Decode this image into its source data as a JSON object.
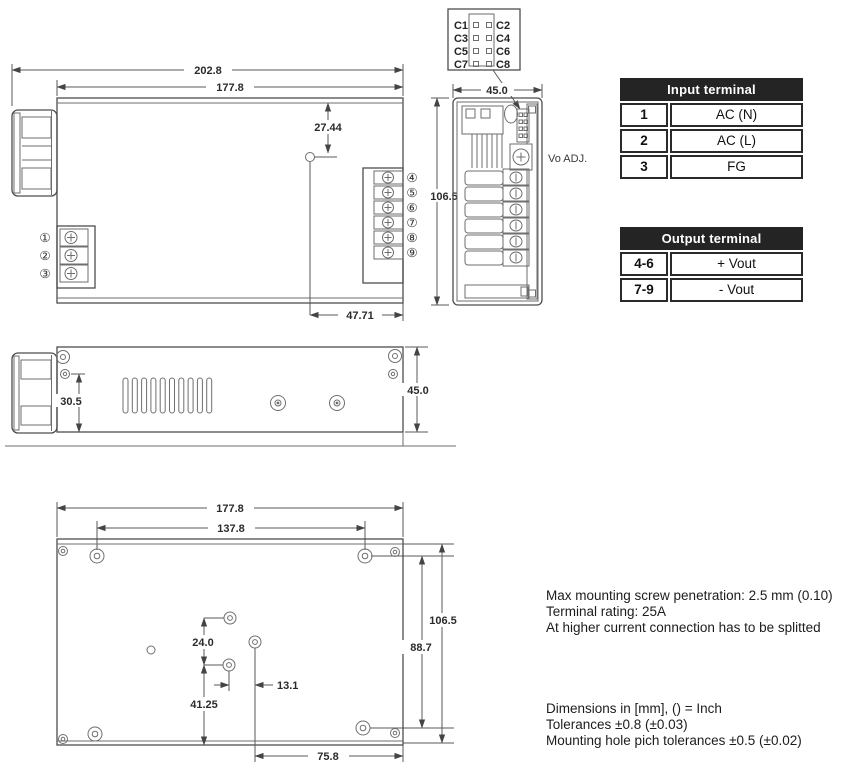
{
  "drawing": {
    "top_view": {
      "dim_overall_width": "202.8",
      "dim_case_width": "177.8",
      "dim_hole_from_top": "27.44",
      "dim_hole_from_right": "47.71",
      "input_terminal_numbers": [
        "①",
        "②",
        "③"
      ],
      "output_terminal_numbers": [
        "④",
        "⑤",
        "⑥",
        "⑦",
        "⑧",
        "⑨"
      ]
    },
    "connector_pinout": {
      "left_pins": [
        "C1",
        "C3",
        "C5",
        "C7"
      ],
      "right_pins": [
        "C2",
        "C4",
        "C6",
        "C8"
      ]
    },
    "end_view": {
      "dim_width": "45.0",
      "dim_height": "106.5",
      "vo_adj_label": "Vo ADJ."
    },
    "side_view": {
      "dim_hole_offset": "30.5",
      "dim_height": "45.0"
    },
    "bottom_view": {
      "dim_case_width": "177.8",
      "dim_mount_pitch_x": "137.8",
      "dim_height": "106.5",
      "dim_mount_pitch_y": "88.7",
      "dim_center_hole_pitch": "24.0",
      "dim_center_offset_x": "13.1",
      "dim_center_offset_y": "41.25",
      "dim_right_offset": "75.8"
    }
  },
  "tables": {
    "input_terminal": {
      "title": "Input terminal",
      "rows": [
        {
          "pin": "1",
          "signal": "AC (N)"
        },
        {
          "pin": "2",
          "signal": "AC (L)"
        },
        {
          "pin": "3",
          "signal": "FG"
        }
      ]
    },
    "output_terminal": {
      "title": "Output terminal",
      "rows": [
        {
          "pin": "4-6",
          "signal": "+ Vout"
        },
        {
          "pin": "7-9",
          "signal": "- Vout"
        }
      ]
    }
  },
  "notes": {
    "spec_lines": [
      "Max mounting screw penetration: 2.5 mm (0.10)",
      "Terminal rating: 25A",
      "At higher current connection has to be splitted"
    ],
    "dimension_lines": [
      "Dimensions in [mm], () = Inch",
      "Tolerances  ±0.8 (±0.03)",
      "Mounting hole pich tolerances ±0.5 (±0.02)"
    ]
  }
}
